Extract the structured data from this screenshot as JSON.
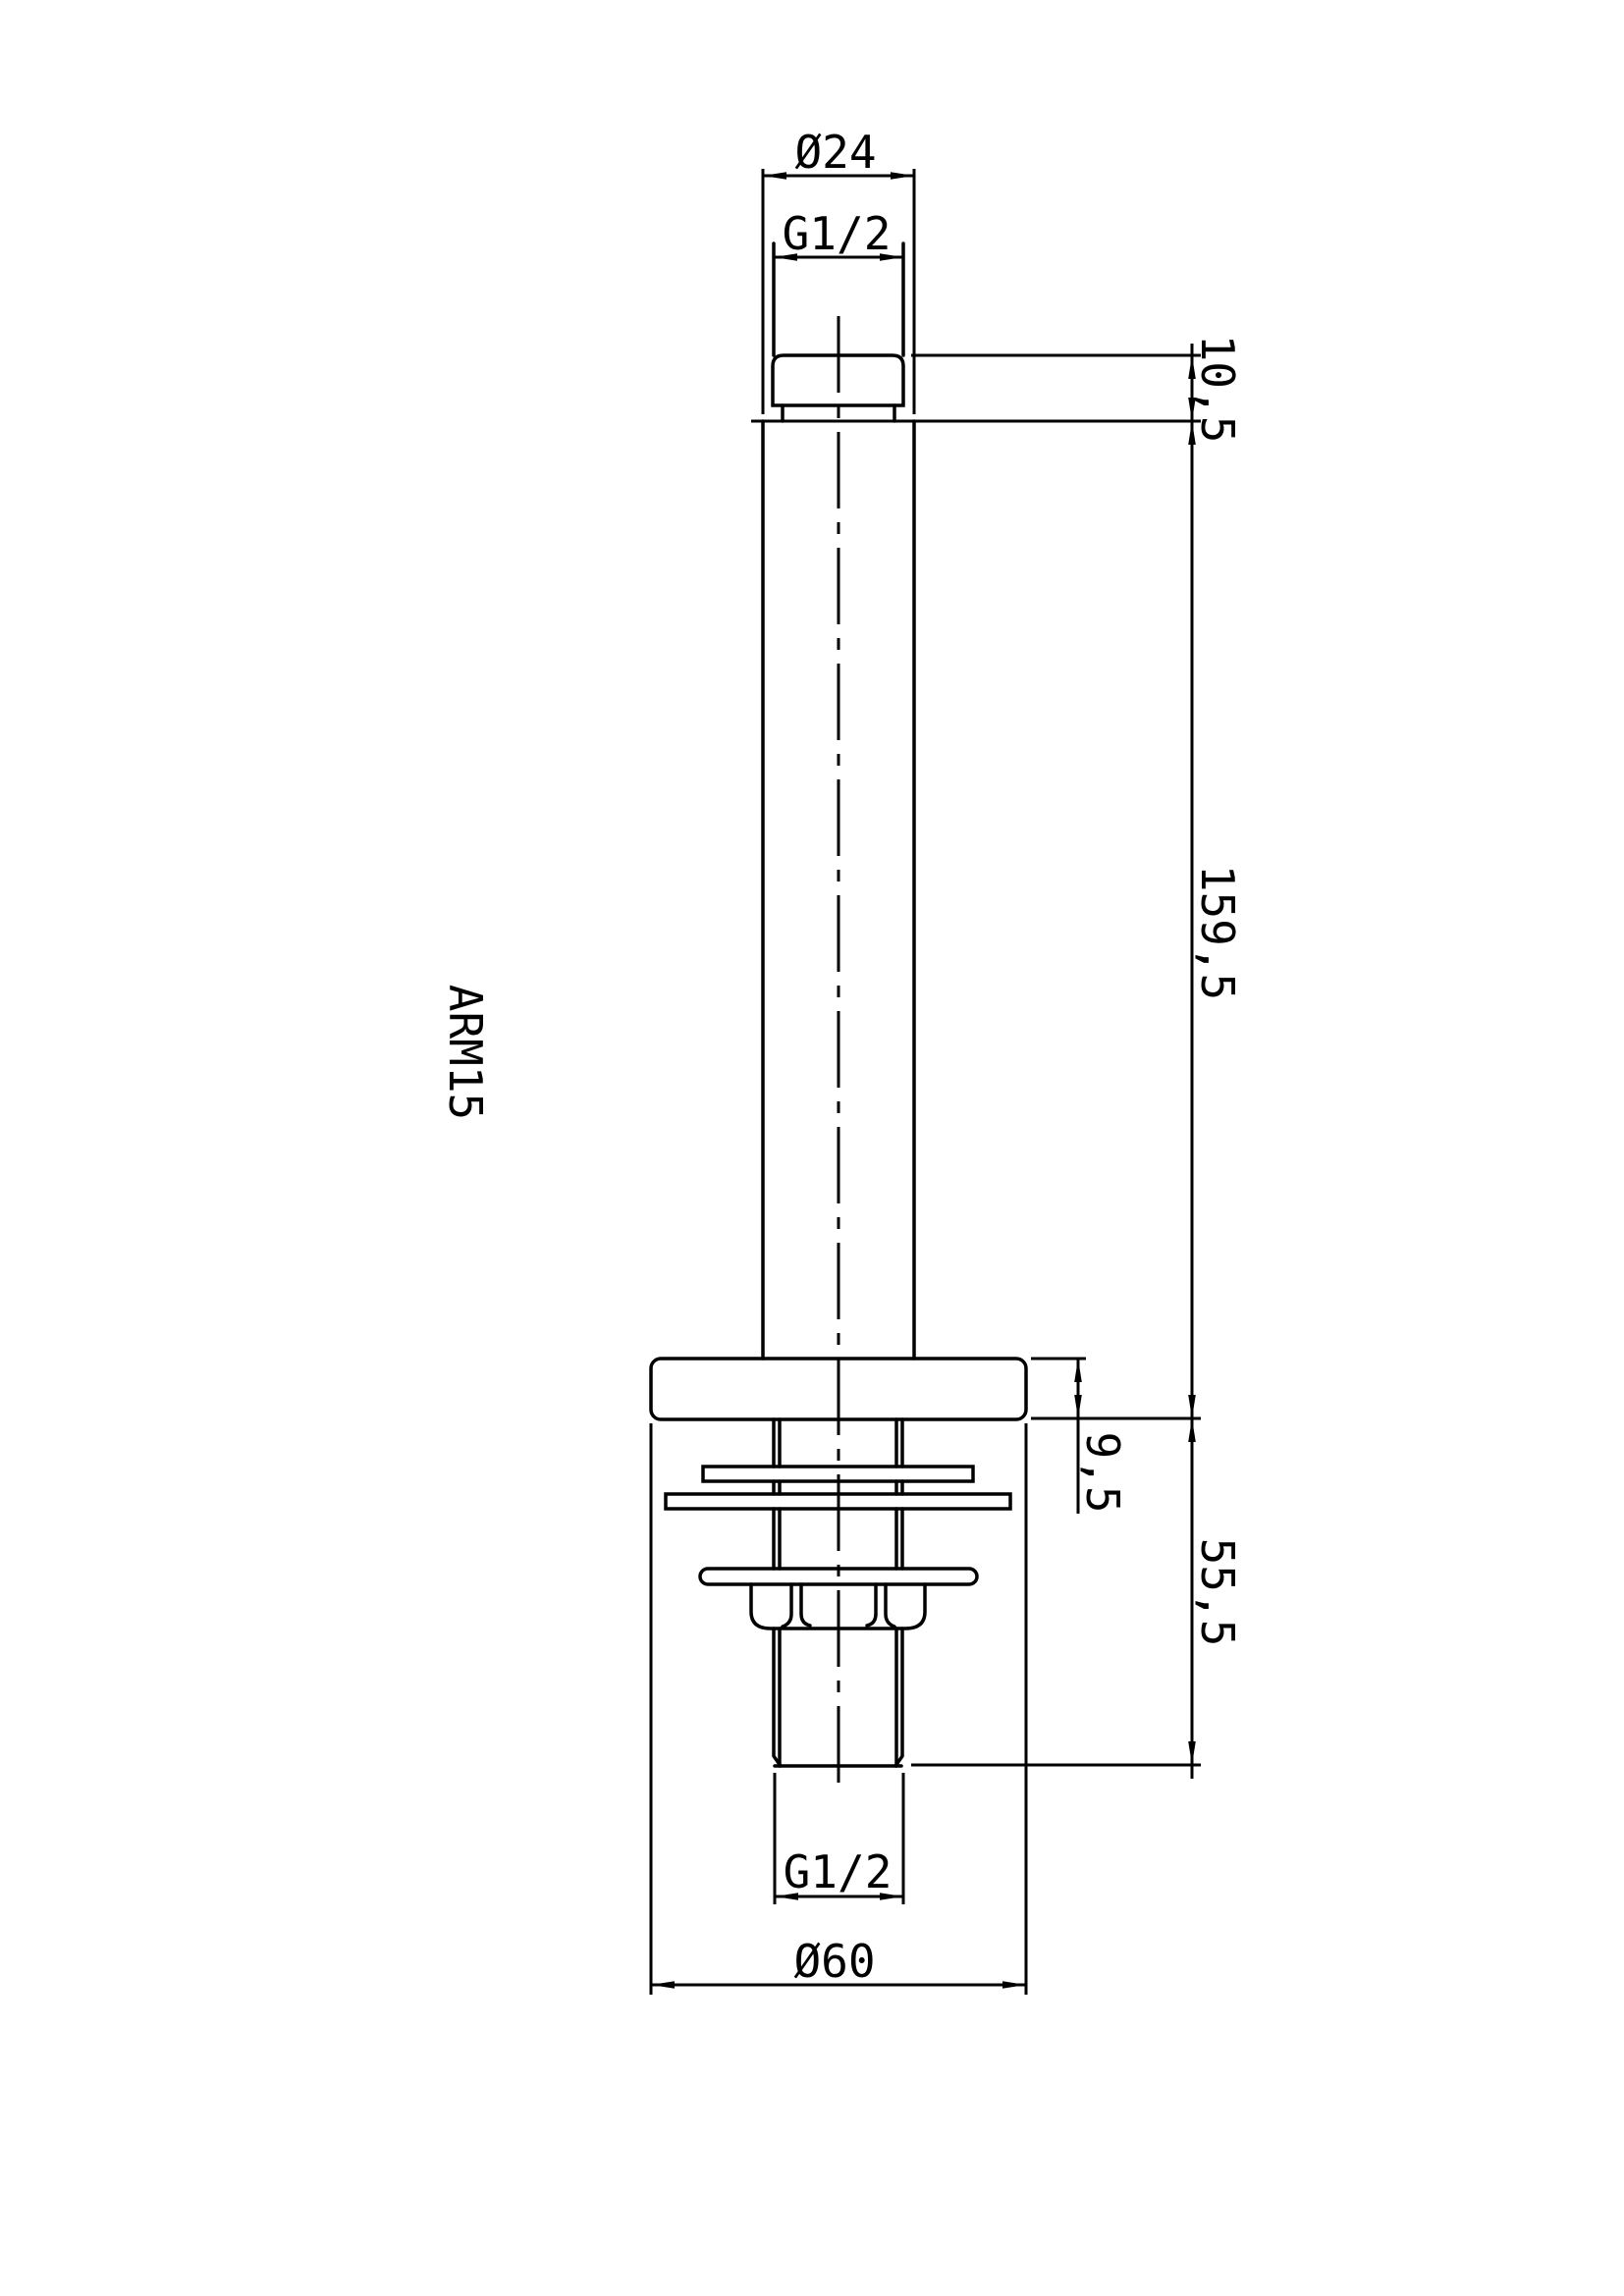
{
  "sheet": {
    "part_label": "ARM15",
    "background": "#ffffff",
    "line_color": "#000000",
    "labels": {
      "top_diameter": "Ø24",
      "top_thread": "G1/2",
      "top_stub_height": "10,5",
      "arm_length": "159,5",
      "flange_thickness": "9,5",
      "below_ceiling_length": "55,5",
      "bottom_thread": "G1/2",
      "flange_diameter": "Ø60"
    }
  }
}
